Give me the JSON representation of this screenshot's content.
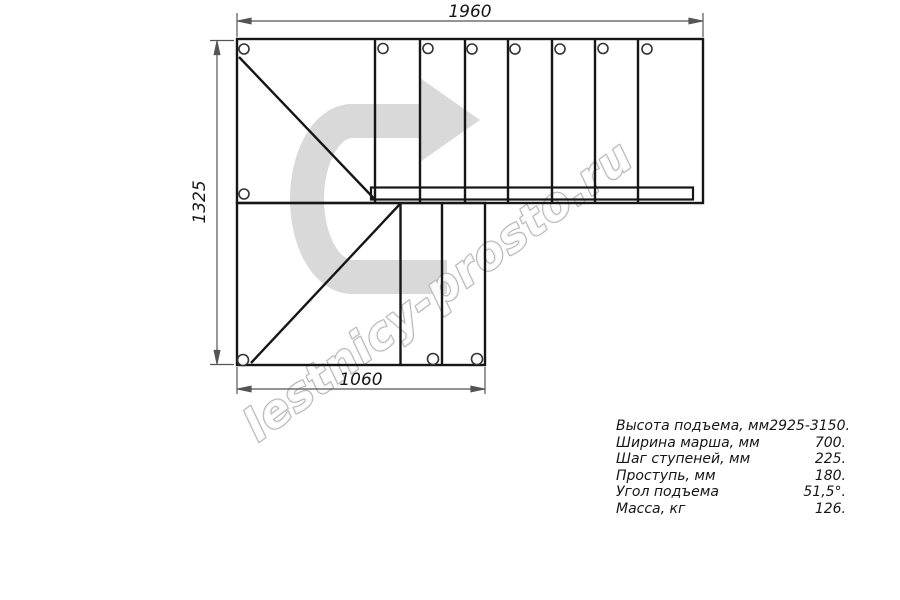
{
  "drawing": {
    "type": "staircase-plan-technical-drawing",
    "dimensions": {
      "top": "1960",
      "left": "1325",
      "bottom": "1060"
    },
    "watermark": "lestnicy-prosto.ru",
    "direction_arrow_icon": "u-turn-right-arrow",
    "counts": {
      "upper_flight_treads": 8,
      "lower_flight_treads": 3,
      "mounting_holes": 12
    },
    "colors": {
      "line": "#161616",
      "dimension": "#555555",
      "arrow_fill": "#d9d9d9",
      "watermark_stroke": "#b6b6b6"
    }
  },
  "specs": {
    "rows": [
      {
        "label": "Высота подъема, мм",
        "value": "2925-3150."
      },
      {
        "label": "Ширина марша, мм",
        "value": "700."
      },
      {
        "label": "Шаг ступеней, мм",
        "value": "225."
      },
      {
        "label": "Проступь, мм",
        "value": "180."
      },
      {
        "label": "Угол подъема",
        "value": "51,5°."
      },
      {
        "label": "Масса, кг",
        "value": "126."
      }
    ]
  }
}
